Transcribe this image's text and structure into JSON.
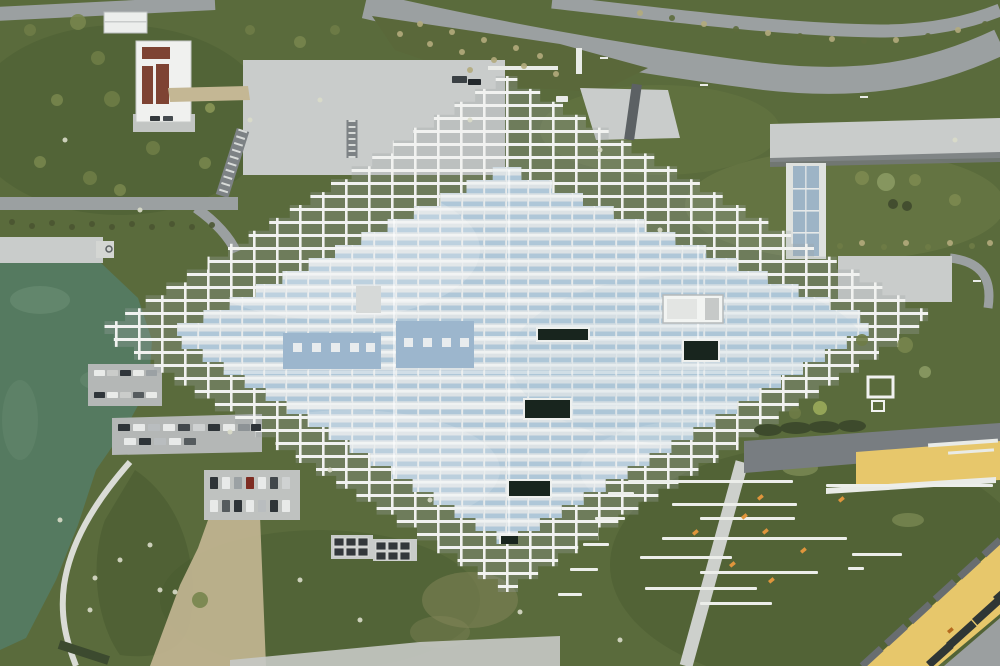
{
  "meta": {
    "title": "Aerial drone view of pixelated lattice-roof building",
    "description": "Top-down aerial photograph of a large diamond-shaped building with a stepped white grid lattice roof and pale blue glazing, beside a green lake with quay and parking piers on the left, curving gray roads on top, lawns with shrubs, bench rows and yellow plazas at the lower right, and a yellow-roofed building in the bottom right corner."
  },
  "scene": {
    "palette": {
      "grass": "#5a6b3c",
      "grass_dark": "#46582e",
      "grass_light": "#71814a",
      "road": "#9ba0a1",
      "road_dark": "#787d81",
      "concrete": "#c9cccb",
      "concrete_bright": "#dfe2df",
      "water": "#557a60",
      "water_light": "#6f9278",
      "gravel": "#c4b794",
      "lattice": "#f1f2f0",
      "glass_base": "#dce2e5",
      "stripe": "#a7c2d6",
      "panel": "#9cb6cd",
      "skylight": "#18251e",
      "yellow": "#e7c76b",
      "bin": "#33383b",
      "bench": "#eceeea",
      "orange": "#e0953c",
      "panelred": "#7e4333",
      "white_path": "#e9ebe7"
    },
    "building": {
      "step": 13,
      "outer": {
        "top": [
          506,
          76
        ],
        "right": [
          934,
          318
        ],
        "bottom": [
          508,
          592
        ],
        "left": [
          99,
          331
        ]
      },
      "inner": {
        "top": [
          506,
          167
        ],
        "right": [
          878,
          324
        ],
        "bottom": [
          507,
          544
        ],
        "left": [
          168,
          334
        ]
      }
    },
    "cars": [
      [
        94,
        370,
        11,
        6,
        "#e9ebe9"
      ],
      [
        107,
        370,
        11,
        6,
        "#caccca"
      ],
      [
        120,
        370,
        11,
        6,
        "#2f353a"
      ],
      [
        133,
        370,
        11,
        6,
        "#e9ebe9"
      ],
      [
        146,
        370,
        11,
        6,
        "#9ba1a4"
      ],
      [
        94,
        392,
        11,
        6,
        "#2f353a"
      ],
      [
        107,
        392,
        11,
        6,
        "#e9ebe9"
      ],
      [
        120,
        392,
        11,
        6,
        "#caccca"
      ],
      [
        133,
        392,
        11,
        6,
        "#555b5e"
      ],
      [
        146,
        392,
        11,
        6,
        "#e9ebe9"
      ],
      [
        118,
        424,
        12,
        7,
        "#2e3438"
      ],
      [
        133,
        424,
        12,
        7,
        "#e8eae9"
      ],
      [
        148,
        424,
        12,
        7,
        "#b9bdbf"
      ],
      [
        163,
        424,
        12,
        7,
        "#e8eae9"
      ],
      [
        178,
        424,
        12,
        7,
        "#41474b"
      ],
      [
        193,
        424,
        12,
        7,
        "#cfd2d2"
      ],
      [
        208,
        424,
        12,
        7,
        "#2e3438"
      ],
      [
        223,
        424,
        12,
        7,
        "#e8eae9"
      ],
      [
        238,
        424,
        12,
        7,
        "#8d9396"
      ],
      [
        251,
        424,
        10,
        7,
        "#2e3438"
      ],
      [
        124,
        438,
        12,
        7,
        "#e8eae9"
      ],
      [
        139,
        438,
        12,
        7,
        "#2e3438"
      ],
      [
        154,
        438,
        12,
        7,
        "#b9bdbf"
      ],
      [
        169,
        438,
        12,
        7,
        "#e8eae9"
      ],
      [
        184,
        438,
        12,
        7,
        "#555b5e"
      ],
      [
        210,
        477,
        8,
        12,
        "#2e3438"
      ],
      [
        222,
        477,
        8,
        12,
        "#e8eae9"
      ],
      [
        234,
        477,
        8,
        12,
        "#9ba1a4"
      ],
      [
        246,
        477,
        8,
        12,
        "#7e2c22"
      ],
      [
        258,
        477,
        8,
        12,
        "#e8eae9"
      ],
      [
        270,
        477,
        8,
        12,
        "#41474b"
      ],
      [
        282,
        477,
        8,
        12,
        "#cfd2d2"
      ],
      [
        210,
        500,
        8,
        12,
        "#e8eae9"
      ],
      [
        222,
        500,
        8,
        12,
        "#555b5e"
      ],
      [
        234,
        500,
        8,
        12,
        "#2e3438"
      ],
      [
        246,
        500,
        8,
        12,
        "#e8eae9"
      ],
      [
        258,
        500,
        8,
        12,
        "#b9bdbf"
      ],
      [
        270,
        500,
        8,
        12,
        "#2e3438"
      ],
      [
        282,
        500,
        8,
        12,
        "#e8eae9"
      ],
      [
        452,
        76,
        15,
        7,
        "#3a4044"
      ],
      [
        468,
        79,
        13,
        6,
        "#23282c"
      ],
      [
        556,
        96,
        12,
        6,
        "#e9ebe9"
      ],
      [
        150,
        116,
        10,
        5,
        "#33383c"
      ],
      [
        163,
        116,
        10,
        5,
        "#454b4f"
      ]
    ],
    "bins": [
      [
        334,
        538
      ],
      [
        346,
        538
      ],
      [
        358,
        538
      ],
      [
        334,
        548
      ],
      [
        346,
        548
      ],
      [
        358,
        548
      ],
      [
        376,
        542
      ],
      [
        388,
        542
      ],
      [
        400,
        542
      ],
      [
        376,
        552
      ],
      [
        388,
        552
      ],
      [
        400,
        552
      ]
    ],
    "benches": [
      [
        628,
        480,
        165
      ],
      [
        672,
        503,
        125
      ],
      [
        700,
        517,
        95
      ],
      [
        662,
        537,
        185
      ],
      [
        640,
        556,
        92
      ],
      [
        700,
        571,
        118
      ],
      [
        645,
        587,
        112
      ],
      [
        700,
        602,
        72
      ],
      [
        826,
        484,
        167
      ],
      [
        852,
        553,
        50
      ],
      [
        848,
        567,
        16
      ],
      [
        608,
        492,
        26
      ],
      [
        595,
        517,
        30
      ],
      [
        583,
        543,
        26
      ],
      [
        570,
        568,
        28
      ],
      [
        558,
        593,
        24
      ]
    ],
    "markers": [
      [
        757,
        498,
        "#e0953c"
      ],
      [
        692,
        533,
        "#e0953c"
      ],
      [
        762,
        532,
        "#e0953c"
      ],
      [
        800,
        551,
        "#e0953c"
      ],
      [
        729,
        565,
        "#e0953c"
      ],
      [
        768,
        581,
        "#e0953c"
      ],
      [
        741,
        517,
        "#e0953c"
      ],
      [
        838,
        500,
        "#e0953c"
      ],
      [
        947,
        631,
        "#b56a1e"
      ]
    ],
    "shrubs": [
      [
        30,
        30,
        6,
        "#6e7c46"
      ],
      [
        78,
        22,
        8,
        "#77854c"
      ],
      [
        98,
        58,
        7,
        "#6e7c46"
      ],
      [
        57,
        100,
        6,
        "#77854c"
      ],
      [
        112,
        99,
        8,
        "#6e7c46"
      ],
      [
        40,
        162,
        6,
        "#77854c"
      ],
      [
        90,
        178,
        7,
        "#6e7c46"
      ],
      [
        120,
        190,
        6,
        "#77854c"
      ],
      [
        153,
        148,
        7,
        "#6e7c46"
      ],
      [
        205,
        163,
        6,
        "#77854c"
      ],
      [
        250,
        30,
        5,
        "#6e7c46"
      ],
      [
        300,
        42,
        6,
        "#77854c"
      ],
      [
        335,
        30,
        5,
        "#6e7c46"
      ],
      [
        210,
        108,
        5,
        "#8a9657"
      ],
      [
        862,
        178,
        7,
        "#7c8a50"
      ],
      [
        886,
        182,
        9,
        "#8a9a63"
      ],
      [
        915,
        180,
        6,
        "#7c8a50"
      ],
      [
        893,
        204,
        5,
        "#3f4a2e"
      ],
      [
        907,
        206,
        5,
        "#3f4a2e"
      ],
      [
        955,
        200,
        6,
        "#7c8a50"
      ],
      [
        862,
        340,
        6,
        "#6e7c46"
      ],
      [
        905,
        345,
        8,
        "#77854c"
      ],
      [
        925,
        372,
        6,
        "#8a9a63"
      ],
      [
        200,
        600,
        8,
        "#77854c"
      ],
      [
        820,
        408,
        7,
        "#9aab5a"
      ],
      [
        795,
        413,
        6,
        "#6e7c46"
      ],
      [
        640,
        13,
        3,
        "#b3ab7c"
      ],
      [
        672,
        18,
        3,
        "#5d6b3c"
      ],
      [
        704,
        24,
        3,
        "#b3ab7c"
      ],
      [
        736,
        29,
        3,
        "#5d6b3c"
      ],
      [
        768,
        33,
        3,
        "#b3ab7c"
      ],
      [
        800,
        36,
        3,
        "#5d6b3c"
      ],
      [
        832,
        39,
        3,
        "#b3ab7c"
      ],
      [
        864,
        41,
        3,
        "#5d6b3c"
      ],
      [
        896,
        40,
        3,
        "#b3ab7c"
      ],
      [
        928,
        36,
        3,
        "#5d6b3c"
      ],
      [
        958,
        30,
        3,
        "#b3ab7c"
      ],
      [
        985,
        24,
        3,
        "#5d6b3c"
      ],
      [
        12,
        222,
        3,
        "#4a5531"
      ],
      [
        32,
        226,
        3,
        "#4a5531"
      ],
      [
        52,
        223,
        3,
        "#4a5531"
      ],
      [
        72,
        227,
        3,
        "#4a5531"
      ],
      [
        92,
        224,
        3,
        "#4a5531"
      ],
      [
        112,
        227,
        3,
        "#4a5531"
      ],
      [
        132,
        224,
        3,
        "#4a5531"
      ],
      [
        152,
        227,
        3,
        "#4a5531"
      ],
      [
        172,
        224,
        3,
        "#4a5531"
      ],
      [
        192,
        227,
        3,
        "#4a5531"
      ],
      [
        212,
        225,
        3,
        "#4a5531"
      ],
      [
        840,
        246,
        3,
        "#6e7c46"
      ],
      [
        862,
        243,
        3,
        "#b3ab7c"
      ],
      [
        884,
        247,
        3,
        "#6e7c46"
      ],
      [
        906,
        243,
        3,
        "#b3ab7c"
      ],
      [
        928,
        247,
        3,
        "#6e7c46"
      ],
      [
        950,
        243,
        3,
        "#b3ab7c"
      ],
      [
        972,
        246,
        3,
        "#6e7c46"
      ],
      [
        990,
        243,
        3,
        "#b3ab7c"
      ],
      [
        400,
        34,
        3,
        "#b3ab7c"
      ],
      [
        430,
        44,
        3,
        "#b3ab7c"
      ],
      [
        462,
        52,
        3,
        "#b3ab7c"
      ],
      [
        494,
        60,
        3,
        "#b3ab7c"
      ],
      [
        524,
        66,
        3,
        "#b3ab7c"
      ],
      [
        556,
        74,
        3,
        "#b3ab7c"
      ],
      [
        420,
        24,
        3,
        "#b3ab7c"
      ],
      [
        452,
        32,
        3,
        "#b3ab7c"
      ],
      [
        484,
        40,
        3,
        "#b3ab7c"
      ],
      [
        516,
        48,
        3,
        "#b3ab7c"
      ],
      [
        470,
        70,
        3,
        "#b3ab7c"
      ],
      [
        540,
        56,
        3,
        "#b3ab7c"
      ]
    ],
    "stones": [
      [
        65,
        140
      ],
      [
        140,
        210
      ],
      [
        250,
        120
      ],
      [
        320,
        100
      ],
      [
        60,
        520
      ],
      [
        120,
        560
      ],
      [
        90,
        610
      ],
      [
        160,
        590
      ],
      [
        230,
        432
      ],
      [
        330,
        470
      ],
      [
        430,
        500
      ],
      [
        300,
        580
      ],
      [
        360,
        620
      ],
      [
        520,
        612
      ],
      [
        620,
        640
      ],
      [
        95,
        578
      ],
      [
        150,
        545
      ],
      [
        175,
        592
      ],
      [
        470,
        120
      ],
      [
        600,
        150
      ],
      [
        660,
        230
      ],
      [
        955,
        140
      ]
    ],
    "hedges": [
      [
        768,
        430,
        14,
        6
      ],
      [
        796,
        428,
        16,
        6
      ],
      [
        824,
        427,
        16,
        6
      ],
      [
        852,
        426,
        14,
        6
      ]
    ],
    "skylights": [
      [
        537,
        328,
        52,
        13
      ],
      [
        683,
        340,
        36,
        21
      ],
      [
        524,
        399,
        47,
        20
      ],
      [
        508,
        480,
        43,
        17
      ],
      [
        500,
        535,
        20,
        14
      ]
    ],
    "panel_squares": [
      [
        293,
        343
      ],
      [
        312,
        343
      ],
      [
        331,
        343
      ],
      [
        350,
        343
      ],
      [
        366,
        343
      ],
      [
        404,
        338
      ],
      [
        423,
        338
      ],
      [
        442,
        338
      ],
      [
        460,
        338
      ]
    ],
    "glass_white_rows": [
      300,
      336,
      371,
      406
    ],
    "glass_seams": [
      393,
      508,
      635,
      697
    ],
    "yellow_slots": [
      [
        946,
        643,
        34,
        8
      ],
      [
        972,
        619,
        34,
        8
      ],
      [
        993,
        597,
        30,
        8
      ],
      [
        926,
        662,
        30,
        8
      ]
    ],
    "road_dashes": [
      [
        600,
        57
      ],
      [
        700,
        84
      ],
      [
        860,
        96
      ],
      [
        973,
        280
      ]
    ]
  }
}
